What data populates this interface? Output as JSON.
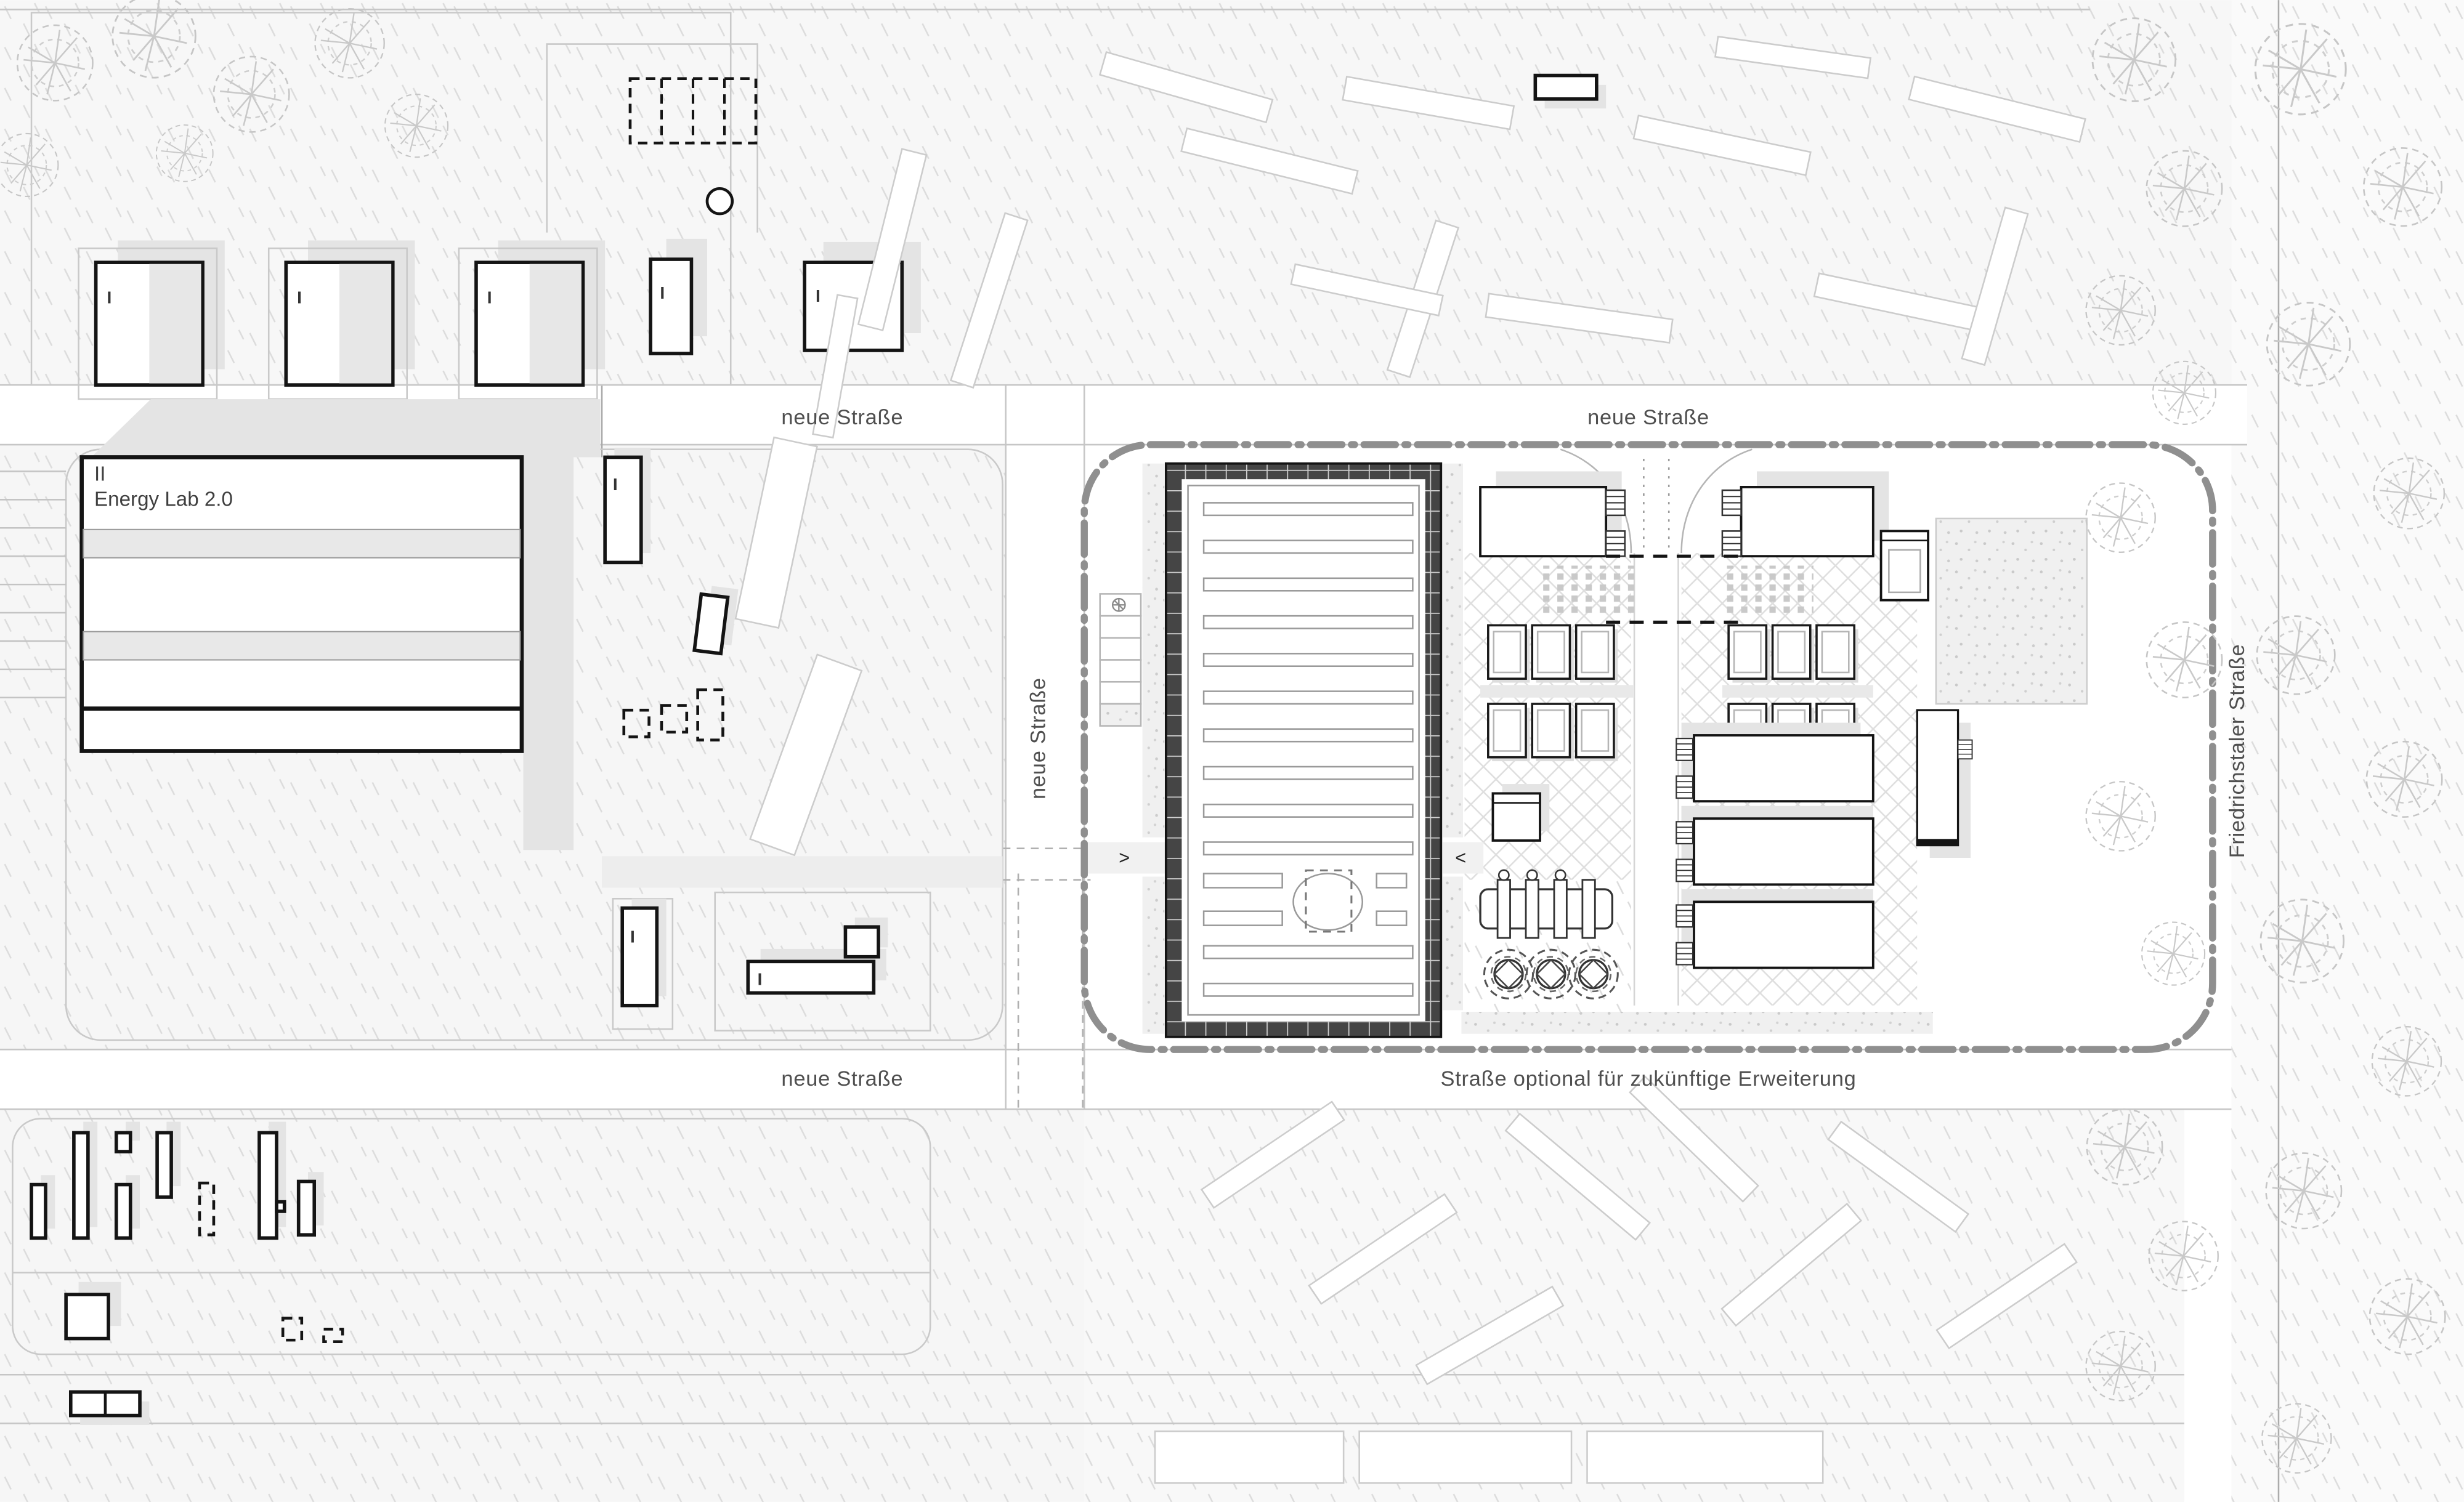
{
  "drawing": {
    "project": "Energy Lab 2.0",
    "energy_lab": {
      "storeys": "II",
      "name": "Energy Lab 2.0"
    },
    "storey_one": "I",
    "streets": {
      "top_left": "neue Straße",
      "top_right": "neue Straße",
      "left_vertical": "neue Straße",
      "bottom": "neue Straße",
      "optional": "Straße optional für zukünftige Erweiterung",
      "right_vertical": "Friedrichstaler Straße"
    },
    "entry_arrows": {
      "west": ">",
      "east": "<"
    },
    "colors": {
      "building_outline": "#141414",
      "hall_wall": "#454545",
      "shadow": "#e4e4e4",
      "label_text": "#4f4f4f",
      "boundary_dashdot": "#8f8f8f"
    }
  }
}
